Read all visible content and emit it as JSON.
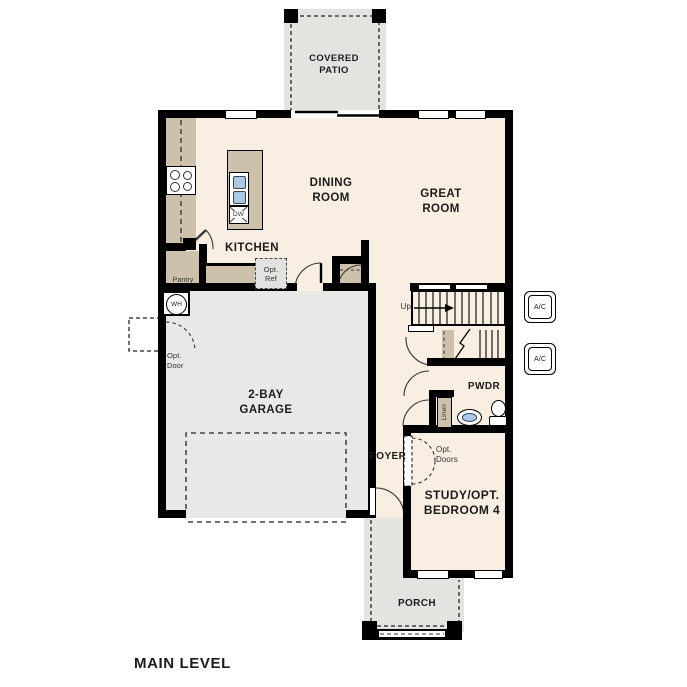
{
  "title": "MAIN LEVEL",
  "colors": {
    "floor": "#f8efe2",
    "garage": "#e8e8e6",
    "patio_porch": "#e3e3e0",
    "counter": "#cec1ab",
    "wall": "#000000",
    "sink_blue": "#aac9e6",
    "optional_gray": "#e2e2e0"
  },
  "rooms": {
    "covered_patio": "COVERED\nPATIO",
    "dining_room": "DINING\nROOM",
    "great_room": "GREAT\nROOM",
    "kitchen": "KITCHEN",
    "garage": "2-BAY\nGARAGE",
    "pwdr": "PWDR",
    "foyer": "FOYER",
    "study": "STUDY/OPT.\nBEDROOM 4",
    "porch": "PORCH"
  },
  "fixtures": {
    "pantry": "Pantry",
    "opt_ref": "Opt.\nRef",
    "opt_door": "Opt.\nDoor",
    "opt_doors": "Opt.\nDoors",
    "water_heater": "WH",
    "dishwasher": "DW",
    "stairs_up": "Up",
    "linen": "Linen",
    "ac": "A/C"
  }
}
